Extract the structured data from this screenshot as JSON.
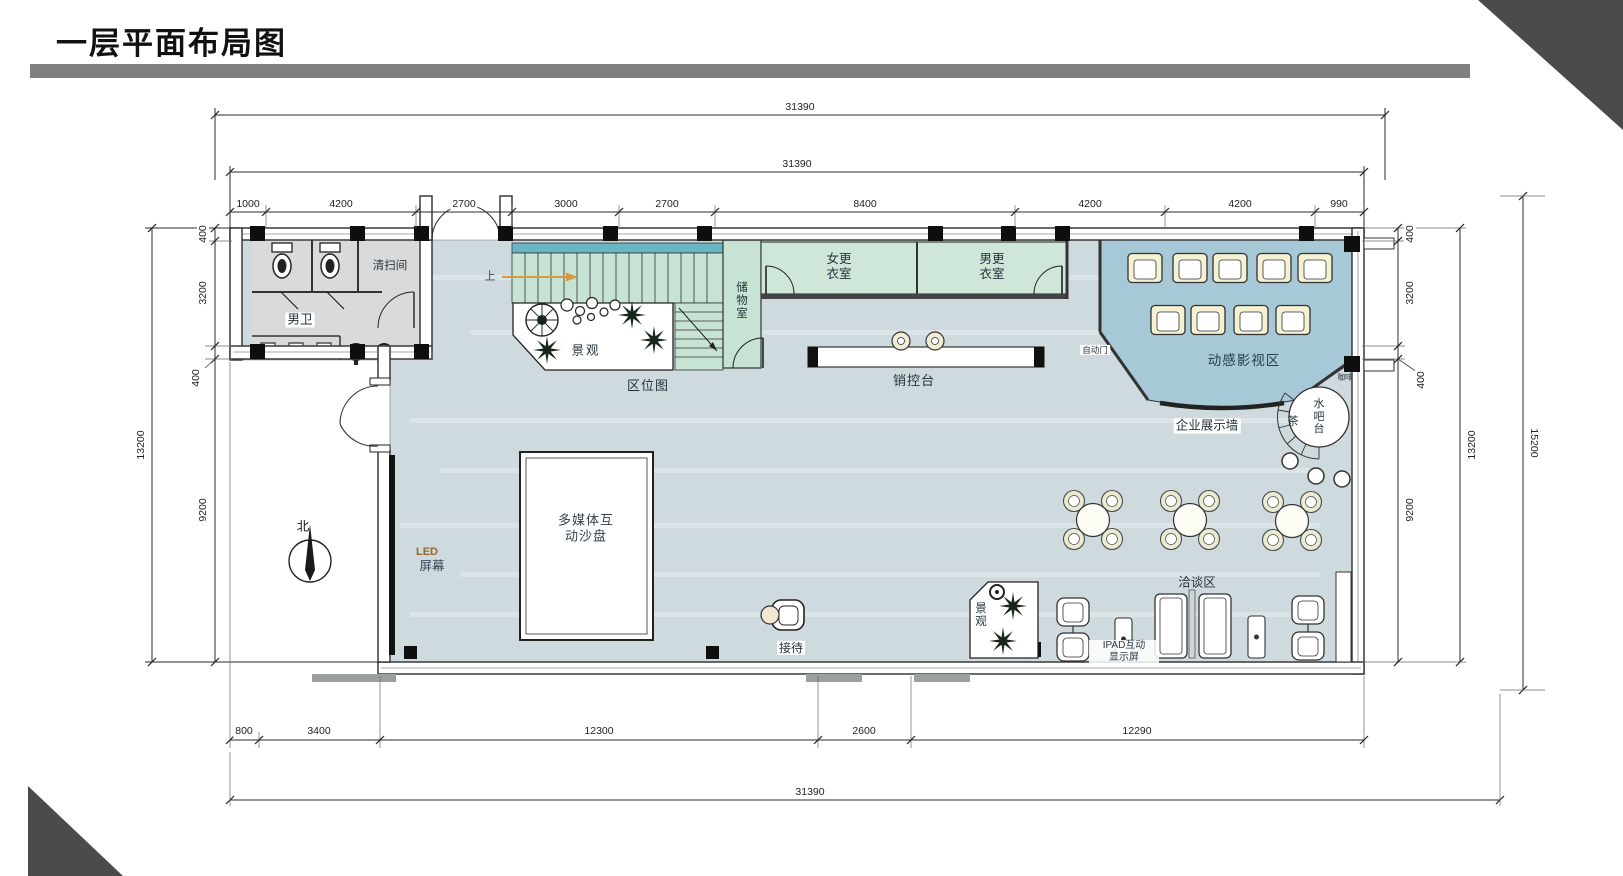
{
  "header": {
    "title": "一层平面布局图"
  },
  "dims": {
    "top_overall_outer": "31390",
    "top_overall_inner": "31390",
    "top_segments": [
      "1000",
      "4200",
      "2700",
      "3000",
      "2700",
      "8400",
      "4200",
      "4200",
      "990"
    ],
    "left_overall": "13200",
    "left_segments": [
      "400",
      "3200",
      "400",
      "9200"
    ],
    "right_overall": "13200",
    "right_segments": [
      "400",
      "3200",
      "400",
      "9200"
    ],
    "far_right_overall": "15200",
    "bottom_segments": [
      "800",
      "3400",
      "12300",
      "2600",
      "12290"
    ],
    "bottom_overall": "31390"
  },
  "labels": {
    "mens_toilet": "男卫",
    "cleaning_room": "清扫间",
    "landscape_top": "景观",
    "location_map": "区位图",
    "stair_up": "上",
    "storage_room": "储物室",
    "womens_changing_room": "女更衣室",
    "mens_changing_room": "男更衣室",
    "sales_control_desk": "销控台",
    "auto_door": "自动门",
    "motion_cinema_zone": "动感影视区",
    "enterprise_display_wall": "企业展示墙",
    "coffee": "咖啡",
    "tea": "茶",
    "water_bar": "水吧台",
    "north": "北",
    "led_line1": "LED",
    "led_line2": "屏幕",
    "multimedia_sand_table": "多媒体互动沙盘",
    "reception": "接待",
    "landscape_bottom": "景观",
    "negotiation_zone": "洽谈区",
    "ipad_line1": "IPAD互动",
    "ipad_line2": "显示屏"
  },
  "colors": {
    "floor": "#cfdade",
    "green_room": "#c6e3d3",
    "cinema_blue": "#a6c8d7",
    "stair_teal": "#68b6c4",
    "toilet_gray": "#dadada",
    "seat_cream": "#f5f1d3",
    "accent_orange": "#d89a3e",
    "wall_dark": "#3a3a3a",
    "banner_gray": "#7f7f7f",
    "corner_dark": "#4b4b4b"
  }
}
